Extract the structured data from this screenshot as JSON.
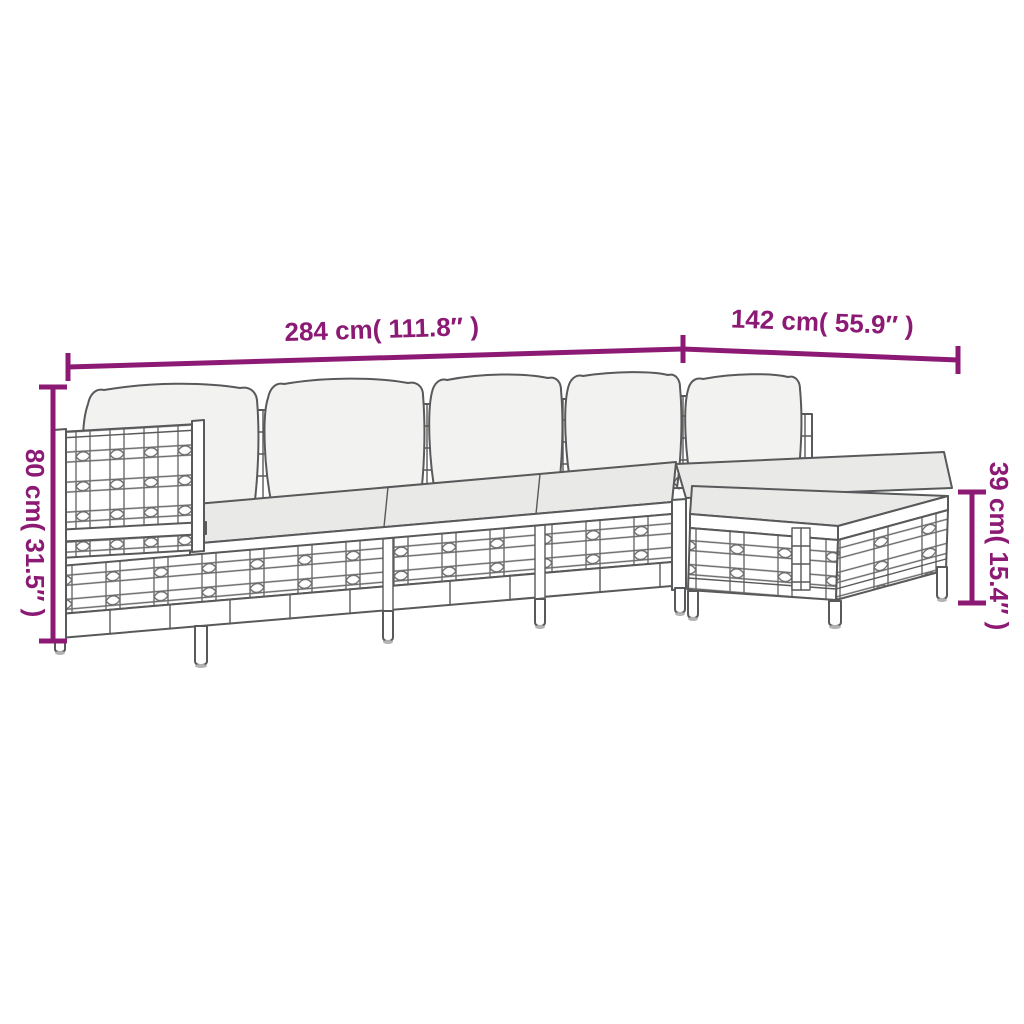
{
  "colors": {
    "background": "#ffffff",
    "dimension_accent": "#8c1a74",
    "line_art": "#58595a",
    "seat_cushion_fill": "#e9e9e7",
    "back_cushion_fill": "#f2f2f0"
  },
  "dimension_labels": {
    "total_width": "284 cm( 111.8″ )",
    "right_section_depth": "142 cm( 55.9″ )",
    "back_height": "80 cm( 31.5″ )",
    "stool_height": "39 cm( 15.4″ )"
  },
  "illustration": {
    "alt": "Line drawing of a 5-piece poly rattan garden lounge set with back cushions, seat cushions and a footstool"
  }
}
